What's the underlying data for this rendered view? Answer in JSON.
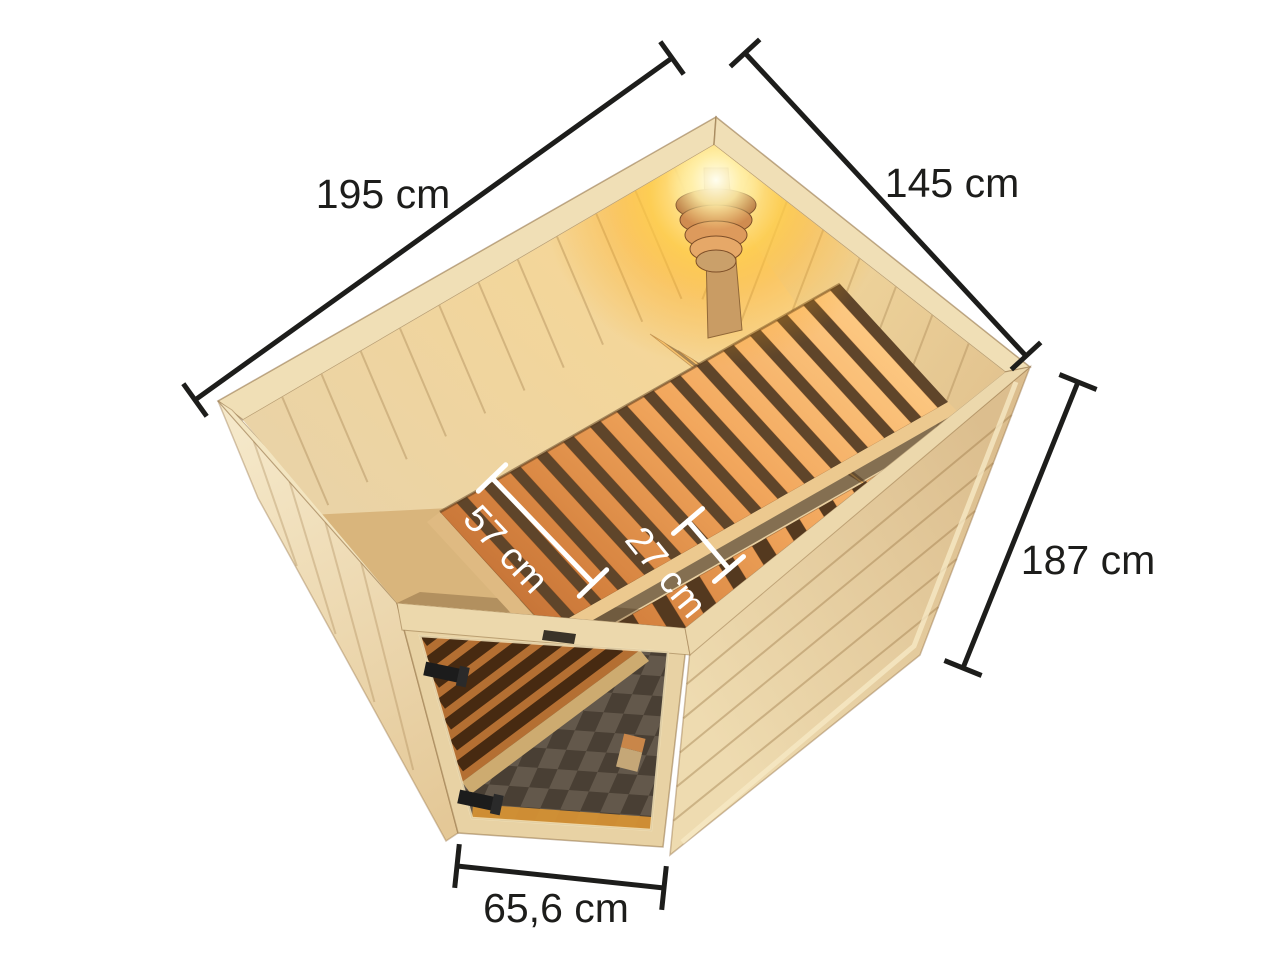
{
  "illustration": {
    "subject": "corner sauna seen from above with interior benches, corner lamp and glass door",
    "colors": {
      "background": "#ffffff",
      "annotation_line": "#1d1d1b",
      "interior_annotation_line": "#ffffff",
      "wall_left_light": "#f5e8c9",
      "wall_left_dark": "#e4c897",
      "wall_right_light": "#eedbb0",
      "wall_right_dark": "#dcbe8e",
      "rim": "#f0dfb6",
      "rim_front": "#ecd8ac",
      "edge_line": "#a5804f",
      "interior_wall": "#e8cfa0",
      "floor_wedge": "#d9b57c",
      "bench_base": "#5f452a",
      "bench_base_low": "#54391f",
      "fascia": "#ecc98f",
      "backrest_slat": "#f6c472",
      "lamp_wood": "#d08c50",
      "post_wood": "#c99c64",
      "door_frame": "#e8d2a4",
      "under_bench_orange": "#cf7f3a",
      "bench_edge_board": "#ecc684",
      "glass_glow_strip": "#f5a93c",
      "checker_dark": "#4f463c",
      "checker_light": "#6e6357",
      "hinge": "#1c1c1c",
      "bucket_top": "#e89a55",
      "bucket_body": "#e3c18c"
    }
  },
  "dimensions": {
    "back_left": {
      "label": "195 cm"
    },
    "back_right": {
      "label": "145 cm"
    },
    "height": {
      "label": "187 cm"
    },
    "door_width": {
      "label": "65,6 cm"
    },
    "bench_depth": {
      "label": "57 cm"
    },
    "side_bench_depth": {
      "label": "27 cm"
    }
  }
}
